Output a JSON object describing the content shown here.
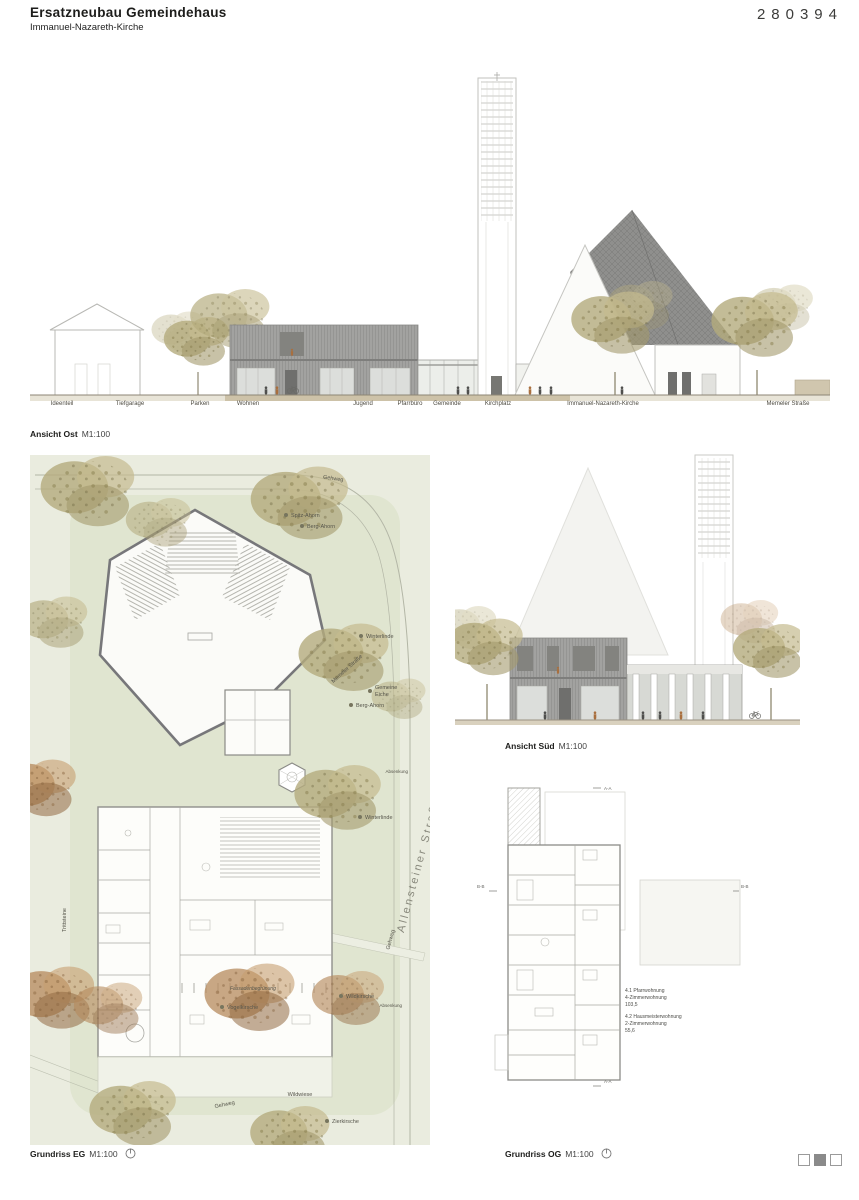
{
  "header": {
    "title": "Ersatzneubau Gemeindehaus",
    "subtitle": "Immanuel-Nazareth-Kirche",
    "entry_number": "280394"
  },
  "east_elevation": {
    "caption": "Ansicht Ost",
    "scale": "M1:100",
    "ground_labels": [
      "Ideenteil",
      "Tiefgarage",
      "Parken",
      "Wohnen",
      "Jugend",
      "Pfarrbüro",
      "Gemeinde",
      "Kirchplatz",
      "Immanuel-Nazareth-Kirche",
      "Memeler Straße"
    ]
  },
  "south_elevation": {
    "caption": "Ansicht Süd",
    "scale": "M1:100"
  },
  "site_plan": {
    "caption": "Grundriss EG",
    "scale": "M1:100",
    "labels": {
      "gehweg_top": "Gehweg",
      "spitz_ahorn": "Spitz-Ahorn",
      "berg_ahorn_1": "Berg-Ahorn",
      "winterlinde_1": "Winterlinde",
      "street_top": "Memeler Straße",
      "eiche_line1": "Gemeine",
      "eiche_line2": "Eiche",
      "berg_ahorn_2": "Berg-Ahorn",
      "absenkung_1": "Absenkung",
      "winterlinde_2": "Winterlinde",
      "trittsteine": "Trittsteine",
      "allensteiner": "Allensteiner Straße",
      "gehweg_diag": "Gehweg",
      "fassadenbegruenung": "Fassadenbegrünung",
      "wildkirsche": "Wildkirsche",
      "vogelkirsche": "Vogelkirsche",
      "absenkung_2": "Absenkung",
      "wildwiese": "Wildwiese",
      "gehweg_bottom": "Gehweg",
      "zierkirsche": "Zierkirsche"
    }
  },
  "og_plan": {
    "caption": "Grundriss OG",
    "scale": "M1:100",
    "annotation": {
      "a1": "4.1 Pfarrwohnung",
      "a2": "4-Zimmerwohnung",
      "a3": "103,5",
      "b1": "4.2 Hausmeisterwohnung",
      "b2": "2-Zimmerwohnung",
      "b3": "55,6"
    },
    "markers": {
      "aa": "A-A",
      "bb": "B-B"
    }
  },
  "page_indicator": {
    "count": 3,
    "active": 2
  },
  "colors": {
    "building_gray": "#a2a2a0",
    "roof_gray": "#909090",
    "ground_tan": "#cdc2a8",
    "plan_paper": "#eaecdf",
    "lawn": "#dce3c9",
    "tree_olive": "#b4ab7d",
    "tree_rust": "#b5895c",
    "text": "#1d1d1b"
  }
}
